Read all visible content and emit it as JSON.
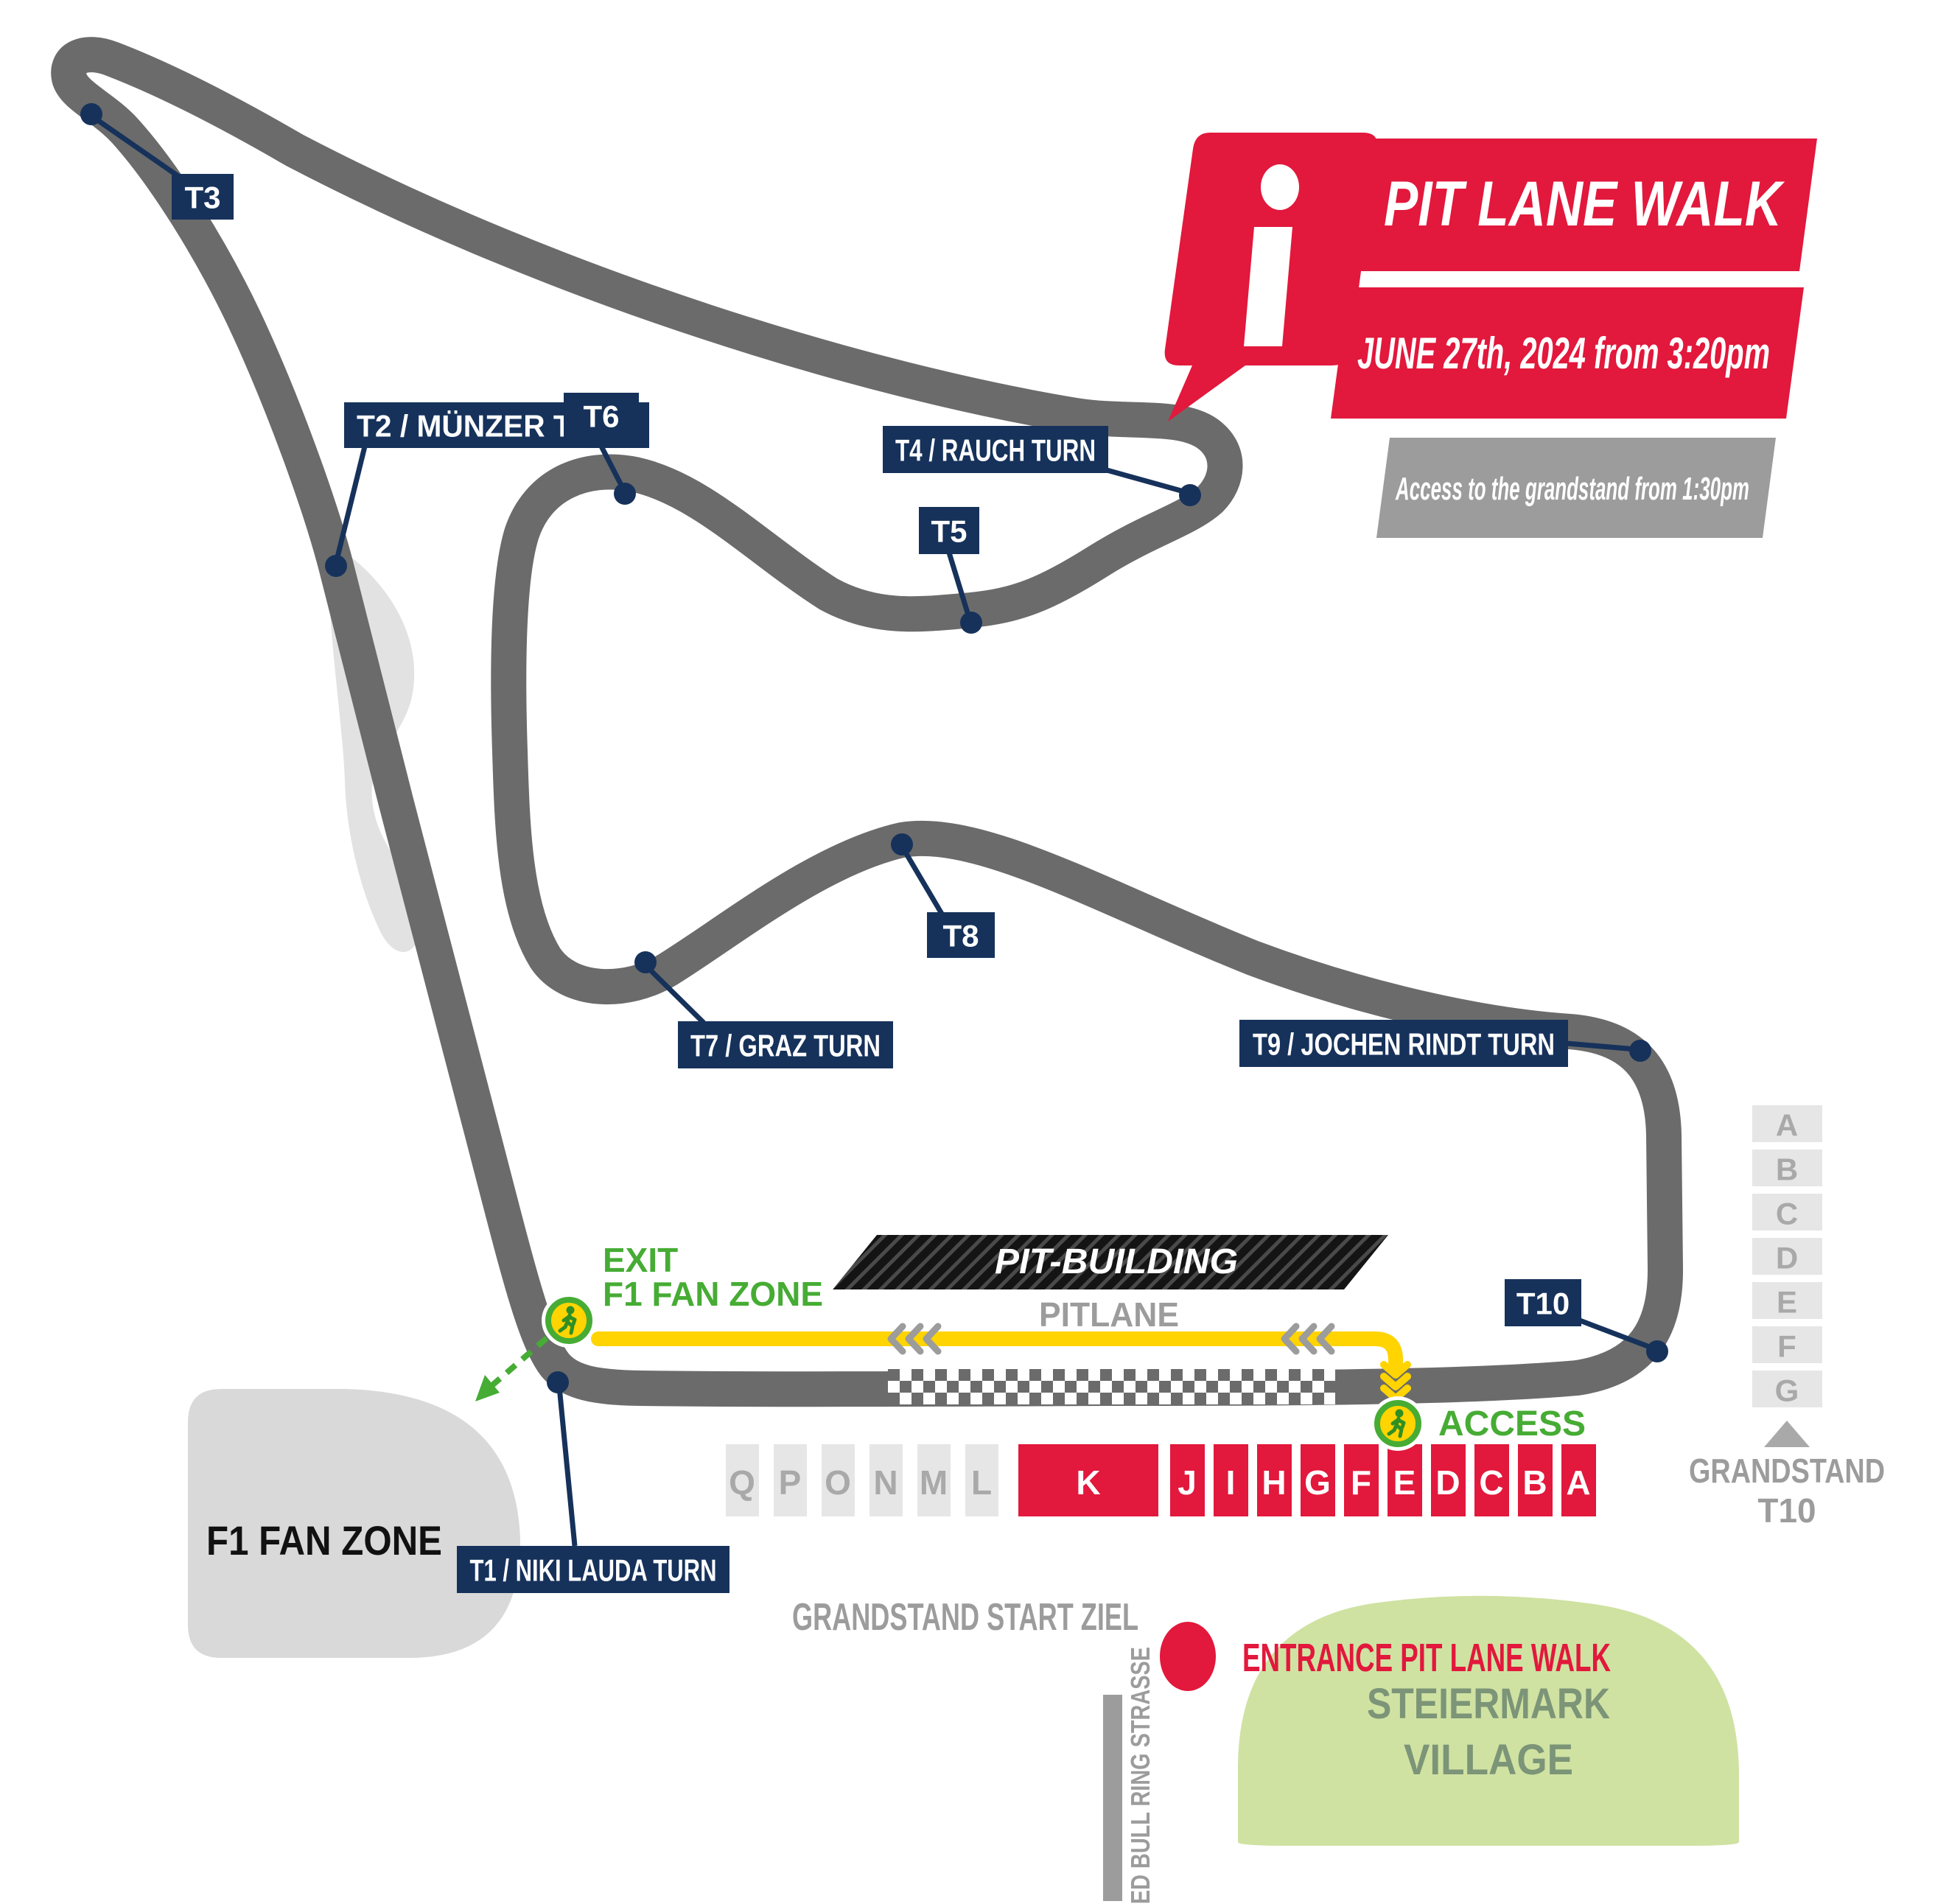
{
  "info_box": {
    "glyph": "i",
    "title": "PIT LANE WALK",
    "date": "JUNE 27th, 2024 from 3:20pm",
    "access_note": "Access to the grandstand from 1:30pm"
  },
  "turns": {
    "t1": "T1 / NIKI LAUDA TURN",
    "t2": "T2 / MÜNZER TURN",
    "t3": "T3",
    "t4": "T4 / RAUCH TURN",
    "t5": "T5",
    "t6": "T6",
    "t7": "T7 / GRAZ TURN",
    "t8": "T8",
    "t9": "T9 / JOCHEN RINDT TURN",
    "t10": "T10"
  },
  "pit": {
    "building": "PIT-BUILDING",
    "lane": "PITLANE"
  },
  "walk": {
    "exit_line1": "EXIT",
    "exit_line2": "F1 FAN ZONE",
    "access": "ACCESS",
    "entrance": "ENTRANCE PIT LANE WALK"
  },
  "zones": {
    "fan_zone": "F1 FAN ZONE",
    "village_line1": "STEIERMARK",
    "village_line2": "VILLAGE",
    "street": "RED BULL RING STRASSE"
  },
  "grandstand_main": {
    "label": "GRANDSTAND START ZIEL",
    "gray_sections": [
      "Q",
      "P",
      "O",
      "N",
      "M",
      "L"
    ],
    "wide_section": "K",
    "red_sections": [
      "J",
      "I",
      "H",
      "G",
      "F",
      "E",
      "D",
      "C",
      "B",
      "A"
    ]
  },
  "grandstand_t10": {
    "sections": [
      "A",
      "B",
      "C",
      "D",
      "E",
      "F",
      "G"
    ],
    "label_line1": "GRANDSTAND",
    "label_line2": "T10"
  },
  "colors": {
    "red": "#E2183C",
    "navy": "#16325B",
    "track_gray": "#6B6B6B",
    "yellow": "#FFD401",
    "green": "#46AC34",
    "gray_text": "#9C9C9C",
    "light_box": "#E6E6E6",
    "box_letter": "#A9A9A9",
    "village_fill": "#CFE2A2",
    "village_text": "#7C9477",
    "fan_zone_fill": "#D9D9D9"
  }
}
